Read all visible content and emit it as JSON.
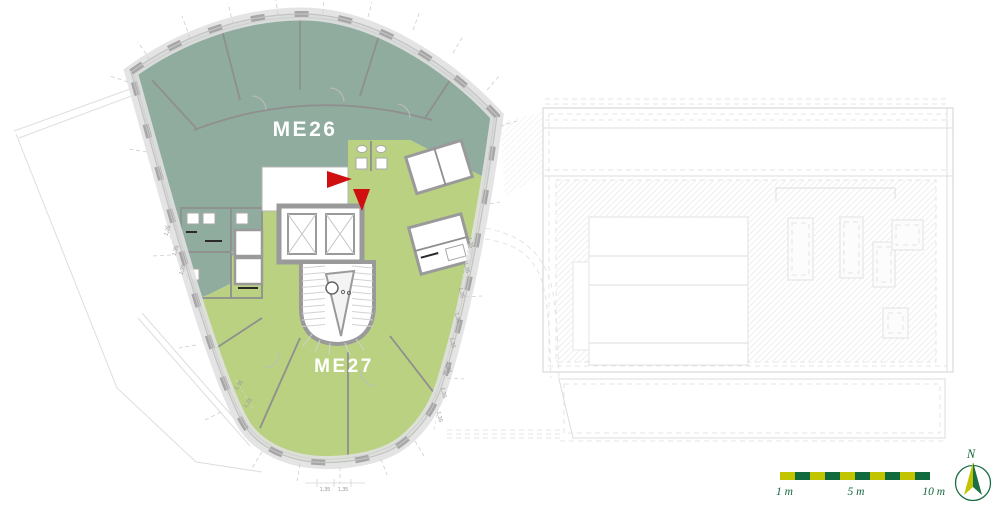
{
  "page": {
    "type": "architectural-floor-plan"
  },
  "units": {
    "me26": {
      "label": "ME26",
      "color": "#8fac9e"
    },
    "me27": {
      "label": "ME27",
      "color": "#b9d180"
    }
  },
  "annotations": {
    "dimension_label": "1,35",
    "entry_marker_color": "#d01010"
  },
  "scale_bar": {
    "segments": 10,
    "label_1": "1 m",
    "label_5": "5 m",
    "label_10": "10 m",
    "color_yellow": "#c2c400",
    "color_green": "#11693e"
  },
  "compass": {
    "label": "N",
    "color": "#1b6f46"
  }
}
